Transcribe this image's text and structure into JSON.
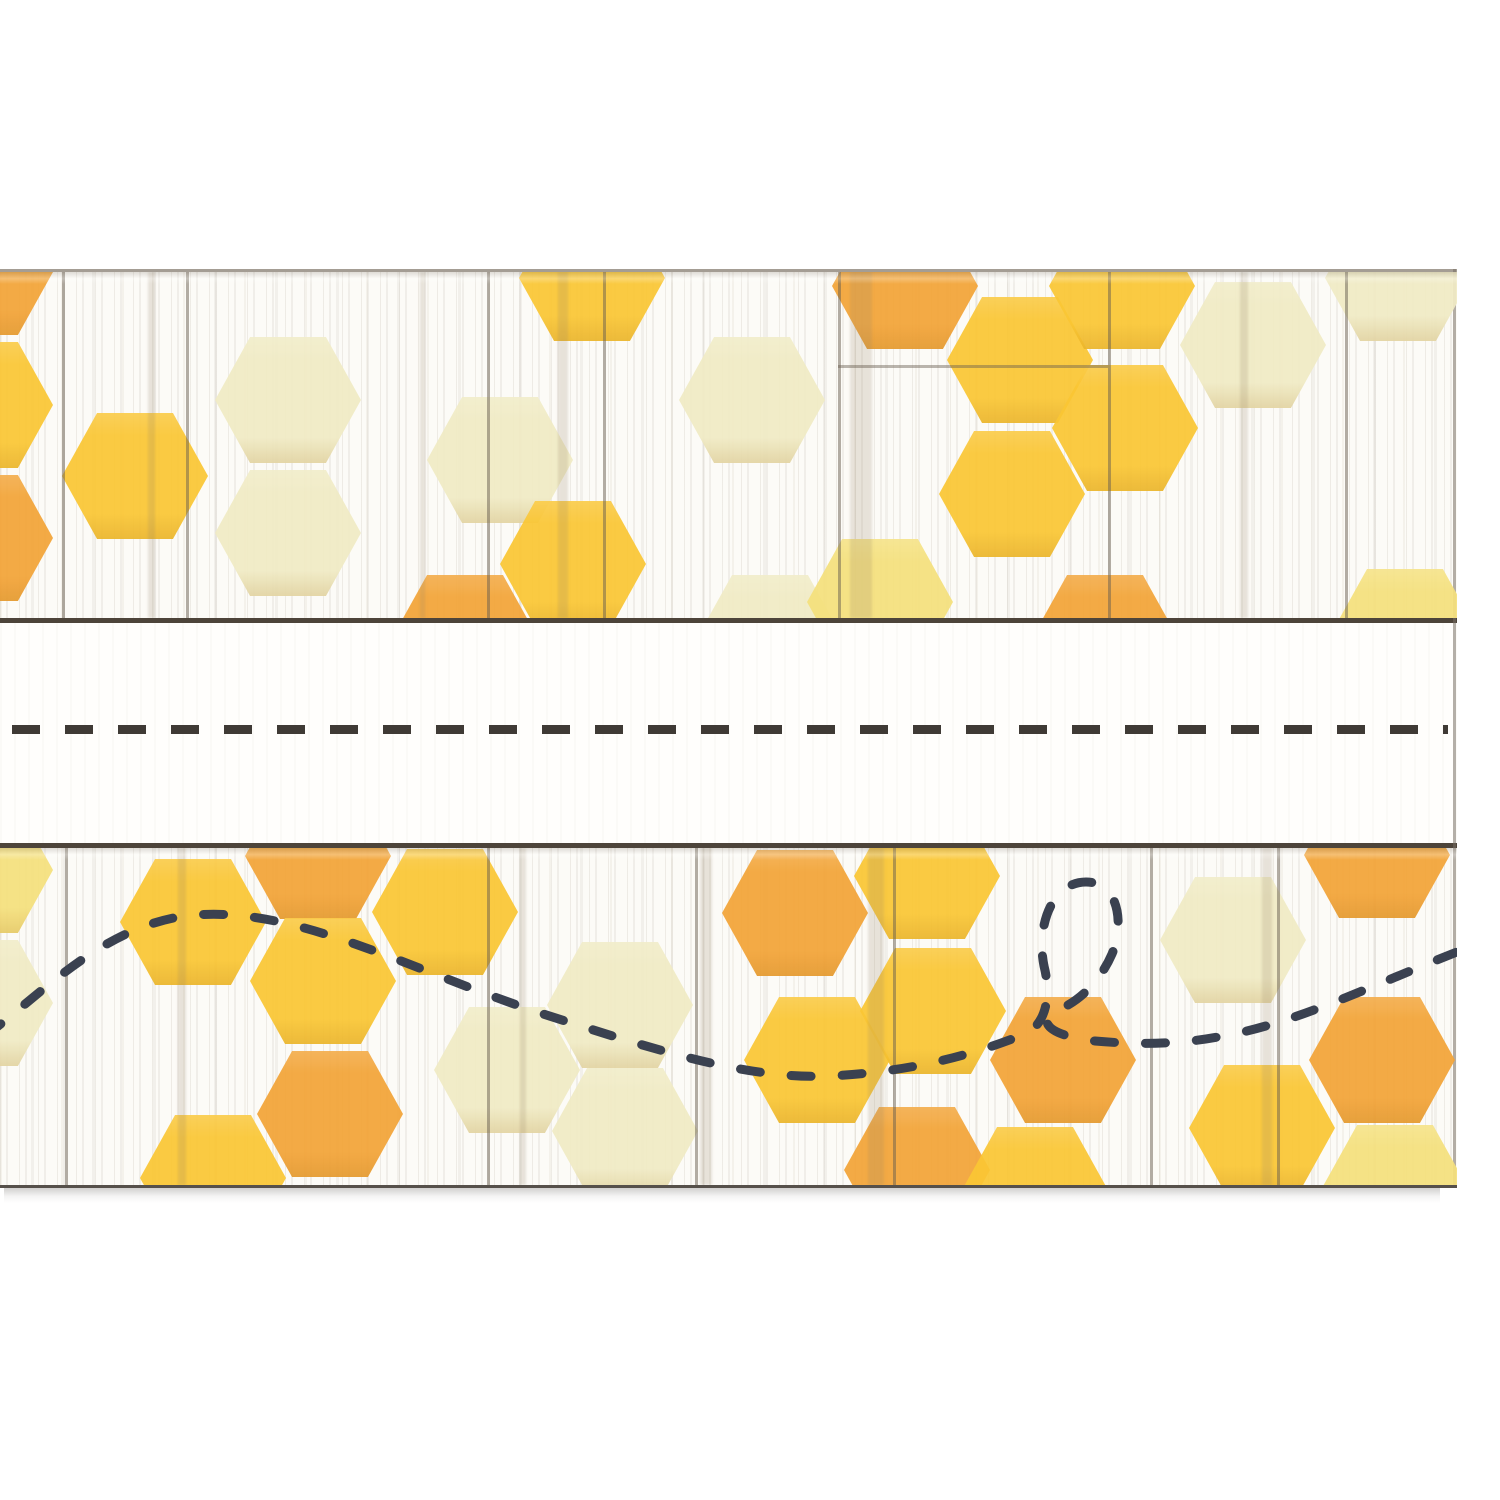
{
  "product": {
    "description": "Honeycomb-pattern classroom name plate on whitewashed shiplap wood, blank white writing strip in the middle, dashed bee flight-path doodle in the lower band",
    "background_color": "#FFFFFF",
    "wood_base_color": "#FCFBF7",
    "divider_line_color": "#4D443A",
    "edge_line_color": "#8D8579",
    "shadow_color": "#5A5650"
  },
  "palette": {
    "gold": "#FAC634",
    "orange": "#F3A437",
    "cream": "#F0EBC4",
    "lemon": "#F5E07C"
  },
  "top_band": {
    "hexagons": [
      {
        "x": -20,
        "y": 0,
        "shade": "orange"
      },
      {
        "x": -20,
        "y": 133,
        "shade": "gold"
      },
      {
        "x": -20,
        "y": 266,
        "shade": "orange"
      },
      {
        "x": 135,
        "y": 204,
        "shade": "gold"
      },
      {
        "x": 288,
        "y": 128,
        "shade": "cream"
      },
      {
        "x": 288,
        "y": 261,
        "shade": "cream"
      },
      {
        "x": 500,
        "y": 188,
        "shade": "cream"
      },
      {
        "x": 592,
        "y": 6,
        "shade": "gold"
      },
      {
        "x": 573,
        "y": 292,
        "shade": "gold"
      },
      {
        "x": 465,
        "y": 366,
        "shade": "orange"
      },
      {
        "x": 752,
        "y": 128,
        "shade": "cream"
      },
      {
        "x": 770,
        "y": 366,
        "shade": "cream"
      },
      {
        "x": 905,
        "y": 14,
        "shade": "orange"
      },
      {
        "x": 880,
        "y": 330,
        "shade": "lemon"
      },
      {
        "x": 1020,
        "y": 88,
        "shade": "gold"
      },
      {
        "x": 1122,
        "y": 14,
        "shade": "gold"
      },
      {
        "x": 1125,
        "y": 156,
        "shade": "gold"
      },
      {
        "x": 1012,
        "y": 222,
        "shade": "gold"
      },
      {
        "x": 1105,
        "y": 366,
        "shade": "orange"
      },
      {
        "x": 1253,
        "y": 73,
        "shade": "cream"
      },
      {
        "x": 1398,
        "y": 6,
        "shade": "cream"
      },
      {
        "x": 1405,
        "y": 360,
        "shade": "lemon"
      }
    ],
    "seams": [
      62,
      186,
      487,
      603,
      838,
      1108,
      1345
    ],
    "streaks": [
      {
        "x": 148,
        "w": 7
      },
      {
        "x": 420,
        "w": 5
      },
      {
        "x": 558,
        "w": 10
      },
      {
        "x": 850,
        "w": 22
      },
      {
        "x": 1240,
        "w": 8
      }
    ],
    "hseams": [
      {
        "y": 93,
        "x": 838,
        "w": 270
      }
    ]
  },
  "writing_strip": {
    "name_line": {
      "color": "#3F3A35",
      "dash": 28,
      "gap": 25,
      "thickness": 9
    }
  },
  "bottom_band": {
    "hexagons": [
      {
        "x": -20,
        "y": 22,
        "shade": "lemon"
      },
      {
        "x": -20,
        "y": 155,
        "shade": "cream"
      },
      {
        "x": 193,
        "y": 74,
        "shade": "gold"
      },
      {
        "x": 213,
        "y": 330,
        "shade": "gold"
      },
      {
        "x": 318,
        "y": 8,
        "shade": "orange"
      },
      {
        "x": 323,
        "y": 133,
        "shade": "gold"
      },
      {
        "x": 330,
        "y": 266,
        "shade": "orange"
      },
      {
        "x": 445,
        "y": 64,
        "shade": "gold"
      },
      {
        "x": 507,
        "y": 222,
        "shade": "cream"
      },
      {
        "x": 620,
        "y": 157,
        "shade": "cream"
      },
      {
        "x": 625,
        "y": 283,
        "shade": "cream"
      },
      {
        "x": 795,
        "y": 65,
        "shade": "orange"
      },
      {
        "x": 927,
        "y": 28,
        "shade": "gold"
      },
      {
        "x": 817,
        "y": 212,
        "shade": "gold"
      },
      {
        "x": 933,
        "y": 163,
        "shade": "gold"
      },
      {
        "x": 917,
        "y": 322,
        "shade": "orange"
      },
      {
        "x": 1063,
        "y": 212,
        "shade": "orange"
      },
      {
        "x": 1035,
        "y": 342,
        "shade": "gold"
      },
      {
        "x": 1233,
        "y": 92,
        "shade": "cream"
      },
      {
        "x": 1262,
        "y": 280,
        "shade": "gold"
      },
      {
        "x": 1382,
        "y": 212,
        "shade": "orange"
      },
      {
        "x": 1377,
        "y": 7,
        "shade": "orange"
      },
      {
        "x": 1395,
        "y": 340,
        "shade": "lemon"
      }
    ],
    "seams": [
      65,
      487,
      695,
      893,
      1150,
      1277
    ],
    "streaks": [
      {
        "x": 178,
        "w": 8
      },
      {
        "x": 520,
        "w": 6
      },
      {
        "x": 700,
        "w": 12
      },
      {
        "x": 868,
        "w": 16
      },
      {
        "x": 1262,
        "w": 10
      }
    ],
    "hseams": [],
    "bee_trail": {
      "color": "#3A4150",
      "thickness": 9,
      "dash_pattern": "20 31",
      "path": "M -15 188 C 40 148, 100 80, 185 68 C 290 55, 400 118, 540 165 C 650 200, 745 232, 830 228 C 905 224, 965 210, 1025 186 C 1045 177, 1052 150, 1044 118 C 1036 78, 1052 34, 1086 34 C 1120 34, 1124 78, 1112 106 C 1098 138, 1075 155, 1058 162 C 1035 172, 1048 188, 1095 193 C 1140 197, 1180 196, 1218 189 C 1295 176, 1365 140, 1462 102"
    }
  }
}
